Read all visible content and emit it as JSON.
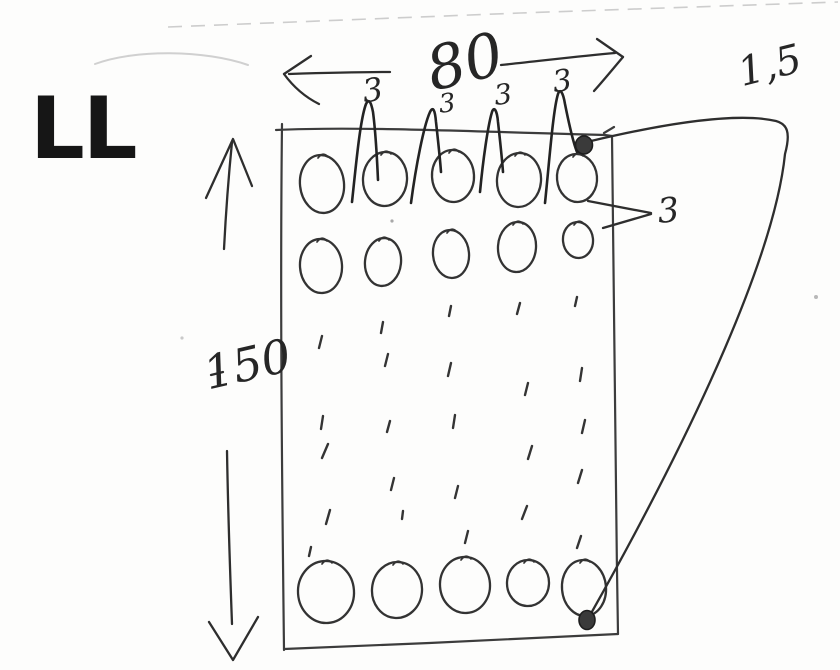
{
  "title": "LL",
  "labels": {
    "width_dim": "80",
    "height_dim": "150",
    "thickness": "1,5",
    "hole_pitch": [
      "3",
      "3",
      "3",
      "3"
    ],
    "hole_diameter": "3"
  },
  "sketch": {
    "ink_color": "#2e2e2e",
    "pencil_color": "#d0d0d0",
    "paper_color": "#fdfdfc",
    "holes": [
      {
        "cx": 322,
        "cy": 184,
        "rx": 22,
        "ry": 29,
        "rot": -6
      },
      {
        "cx": 385,
        "cy": 179,
        "rx": 22,
        "ry": 27,
        "rot": 4
      },
      {
        "cx": 453,
        "cy": 176,
        "rx": 21,
        "ry": 26,
        "rot": -3
      },
      {
        "cx": 519,
        "cy": 180,
        "rx": 22,
        "ry": 27,
        "rot": 5
      },
      {
        "cx": 577,
        "cy": 178,
        "rx": 20,
        "ry": 24,
        "rot": -5
      },
      {
        "cx": 321,
        "cy": 266,
        "rx": 21,
        "ry": 27,
        "rot": -4
      },
      {
        "cx": 383,
        "cy": 262,
        "rx": 18,
        "ry": 24,
        "rot": 6
      },
      {
        "cx": 451,
        "cy": 254,
        "rx": 18,
        "ry": 24,
        "rot": -5
      },
      {
        "cx": 517,
        "cy": 247,
        "rx": 19,
        "ry": 25,
        "rot": 4
      },
      {
        "cx": 578,
        "cy": 240,
        "rx": 15,
        "ry": 18,
        "rot": -6
      },
      {
        "cx": 326,
        "cy": 592,
        "rx": 28,
        "ry": 31,
        "rot": -4
      },
      {
        "cx": 397,
        "cy": 590,
        "rx": 25,
        "ry": 28,
        "rot": 5
      },
      {
        "cx": 465,
        "cy": 585,
        "rx": 25,
        "ry": 28,
        "rot": -4
      },
      {
        "cx": 528,
        "cy": 583,
        "rx": 21,
        "ry": 23,
        "rot": 3
      },
      {
        "cx": 584,
        "cy": 588,
        "rx": 22,
        "ry": 28,
        "rot": -5
      }
    ],
    "continuation_dashes": [
      [
        322,
        336,
        -3,
        12
      ],
      [
        383,
        322,
        -2,
        11
      ],
      [
        451,
        306,
        -2,
        10
      ],
      [
        520,
        303,
        -3,
        11
      ],
      [
        577,
        297,
        -2,
        9
      ],
      [
        388,
        354,
        -3,
        12
      ],
      [
        451,
        363,
        -3,
        13
      ],
      [
        582,
        368,
        -2,
        13
      ],
      [
        528,
        383,
        -3,
        12
      ],
      [
        323,
        416,
        -2,
        13
      ],
      [
        390,
        421,
        -3,
        11
      ],
      [
        455,
        415,
        -2,
        13
      ],
      [
        585,
        420,
        -3,
        13
      ],
      [
        328,
        444,
        -6,
        14
      ],
      [
        532,
        446,
        -4,
        13
      ],
      [
        582,
        470,
        -4,
        13
      ],
      [
        394,
        478,
        -3,
        12
      ],
      [
        458,
        486,
        -3,
        12
      ],
      [
        330,
        510,
        -4,
        14
      ],
      [
        403,
        511,
        -1,
        8
      ],
      [
        527,
        506,
        -5,
        13
      ],
      [
        468,
        531,
        -3,
        12
      ],
      [
        581,
        536,
        -4,
        12
      ],
      [
        311,
        547,
        -2,
        9
      ]
    ],
    "anchor_dots": [
      {
        "cx": 584,
        "cy": 145,
        "rx": 8.5,
        "ry": 9
      },
      {
        "cx": 587,
        "cy": 620,
        "rx": 8,
        "ry": 9.5
      }
    ]
  }
}
